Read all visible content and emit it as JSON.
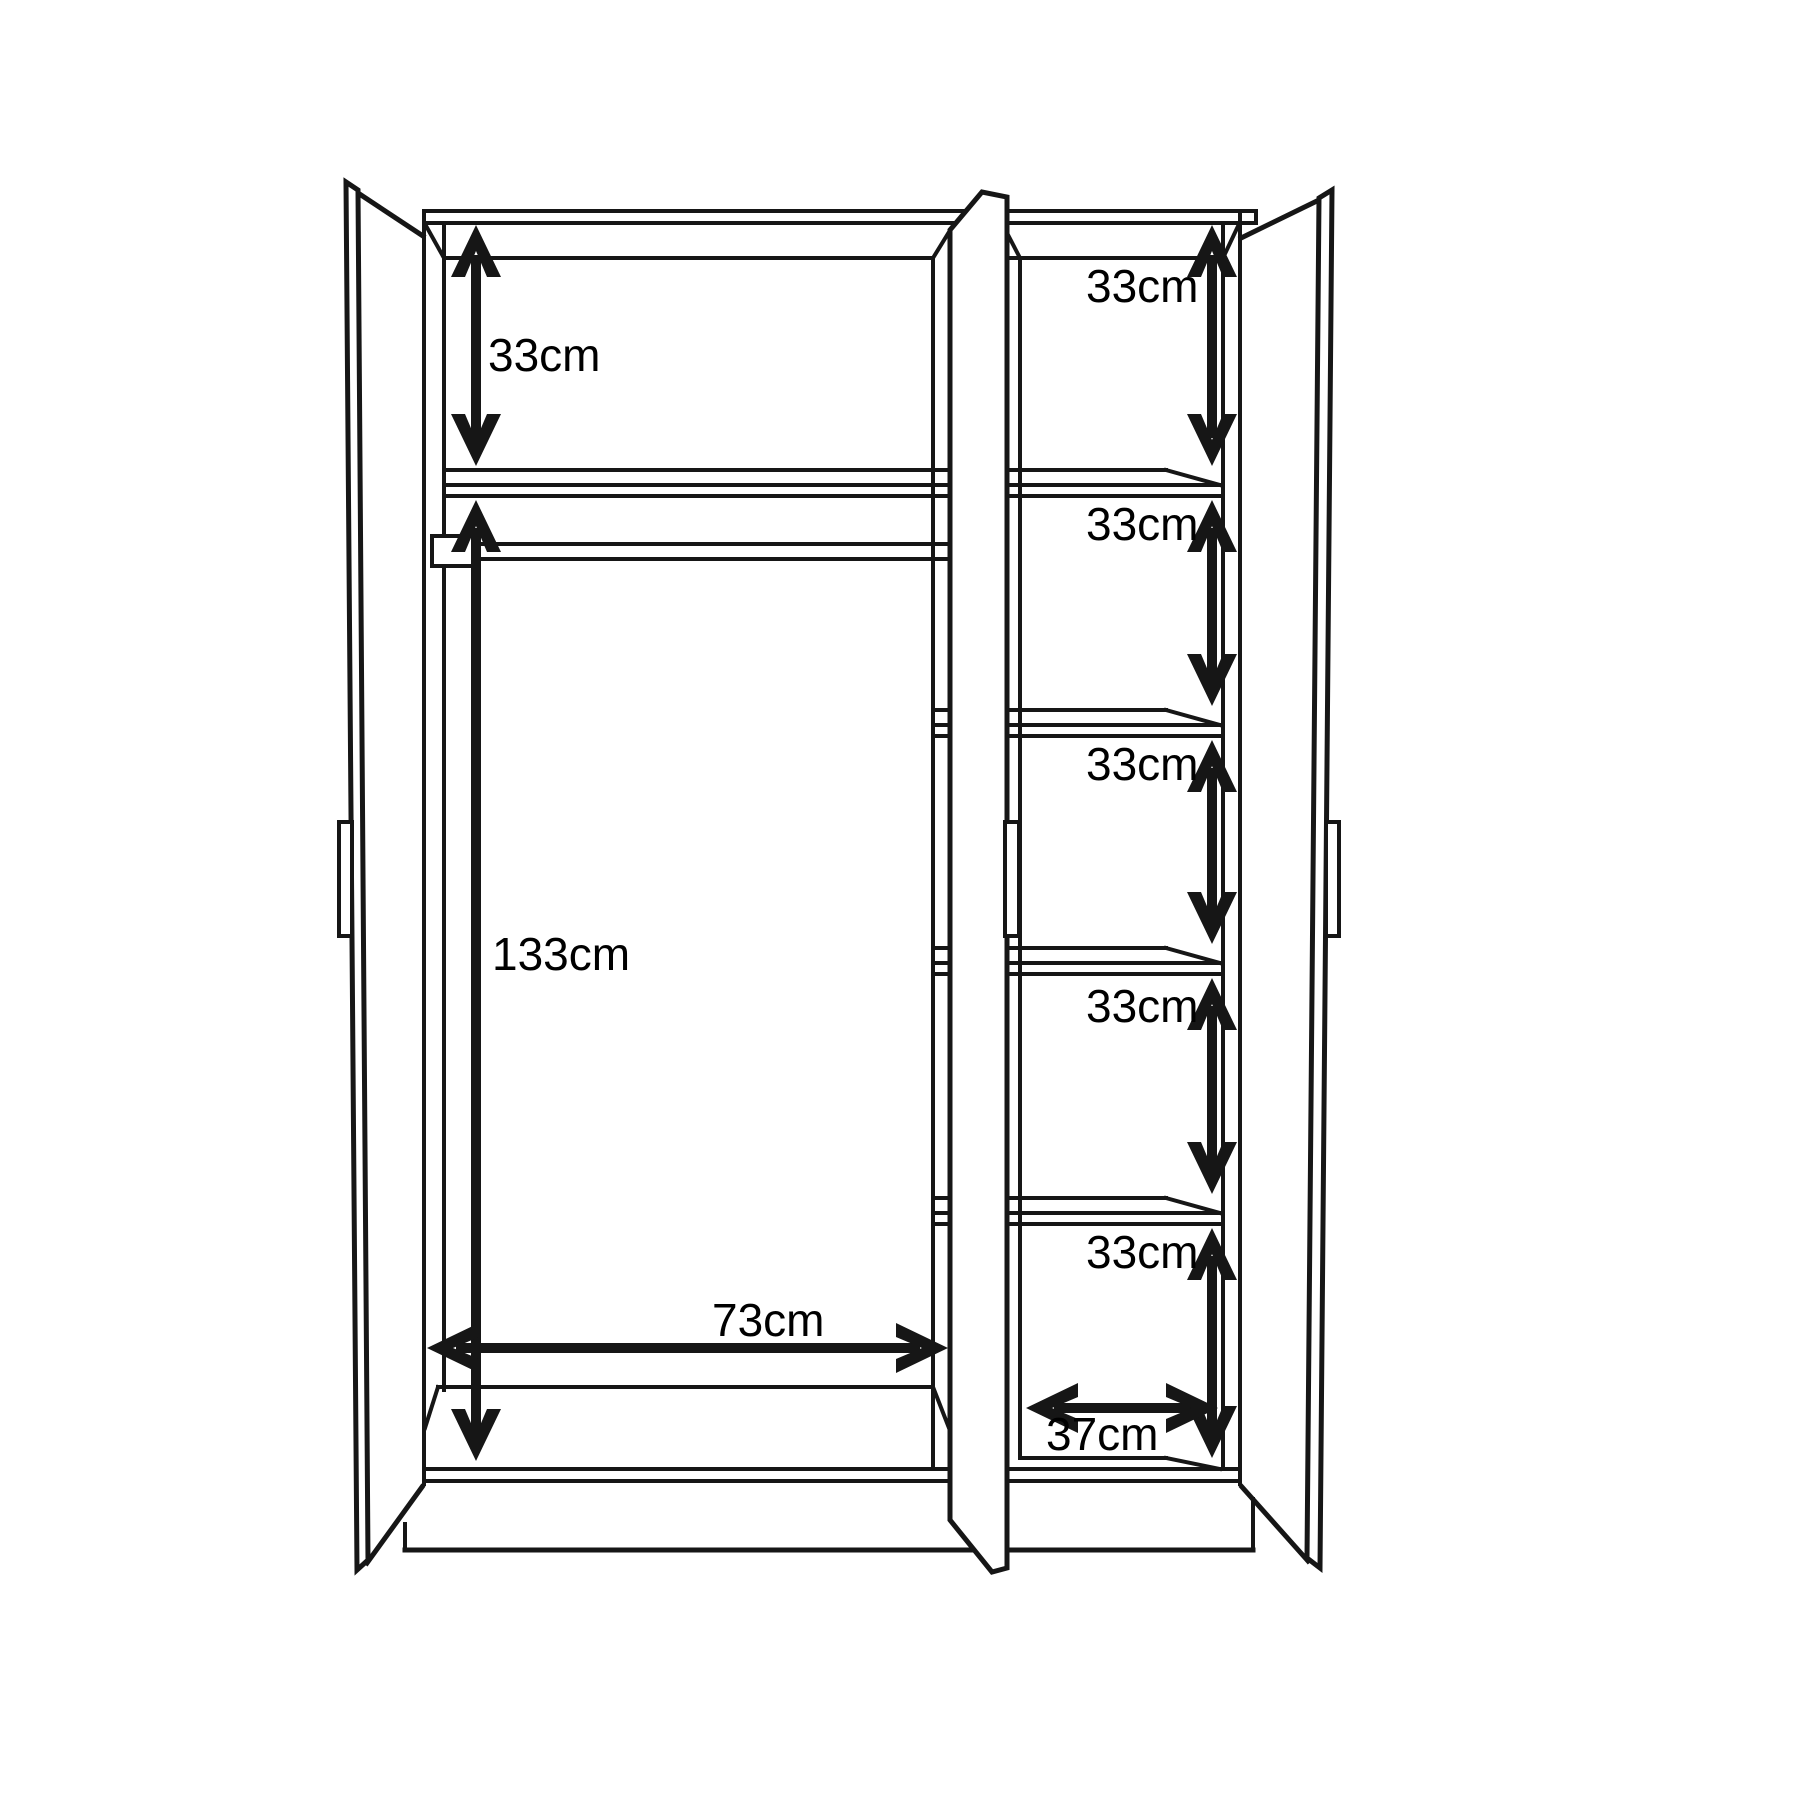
{
  "diagram": {
    "kind": "wardrobe internal dimensions line drawing",
    "doors": 3,
    "colors": {
      "background": "#ffffff",
      "line": "#161616",
      "text": "#000000"
    },
    "left_section": {
      "top_compartment_height": "33cm",
      "hanging_space_height": "133cm",
      "width": "73cm"
    },
    "right_section": {
      "shelf_heights": [
        "33cm",
        "33cm",
        "33cm",
        "33cm",
        "33cm"
      ],
      "width": "37cm"
    }
  }
}
